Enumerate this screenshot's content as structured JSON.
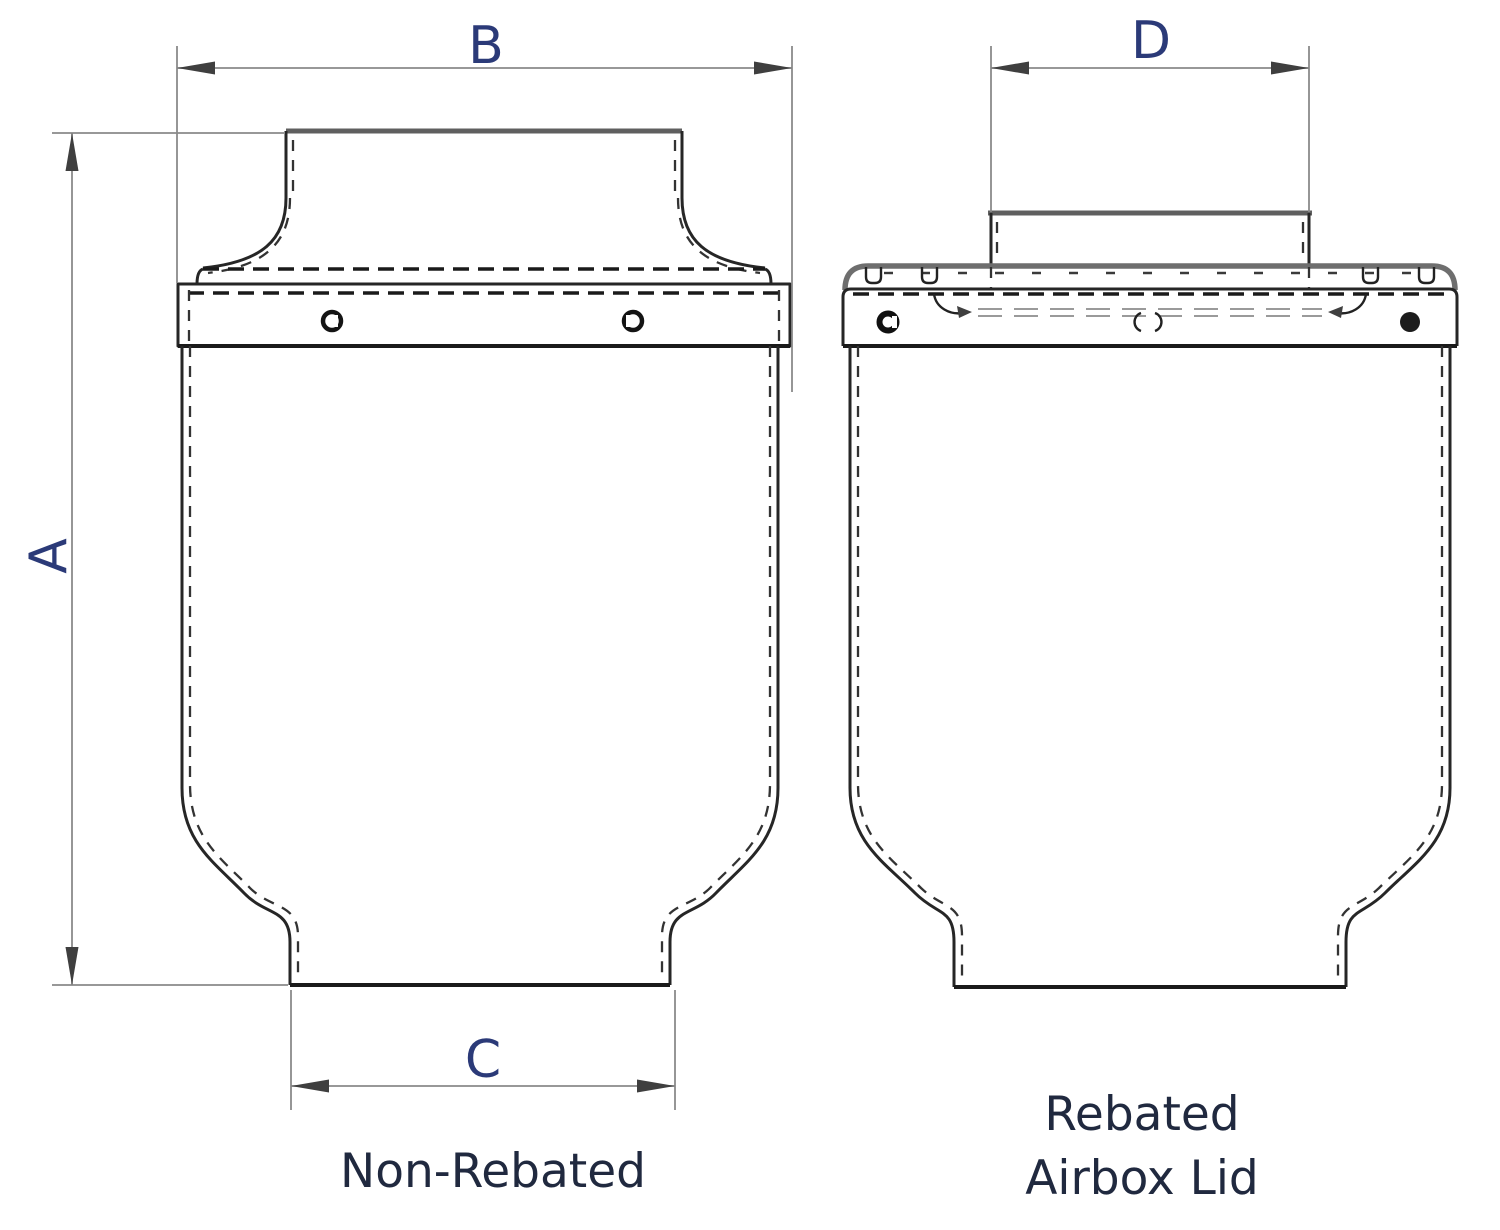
{
  "figures": {
    "non_rebated": {
      "caption": "Non-Rebated",
      "dimensions": {
        "overall_height_label": "A",
        "flange_width_label": "B",
        "base_width_label": "C"
      }
    },
    "rebated": {
      "caption_line1": "Rebated",
      "caption_line2": "Airbox Lid",
      "dimensions": {
        "spigot_width_label": "D"
      }
    }
  },
  "colors": {
    "dimension_label": "#2b3a78",
    "caption_text": "#20293f",
    "outline": "#262626",
    "dimension_line": "#8a8a8a",
    "background": "#ffffff"
  }
}
